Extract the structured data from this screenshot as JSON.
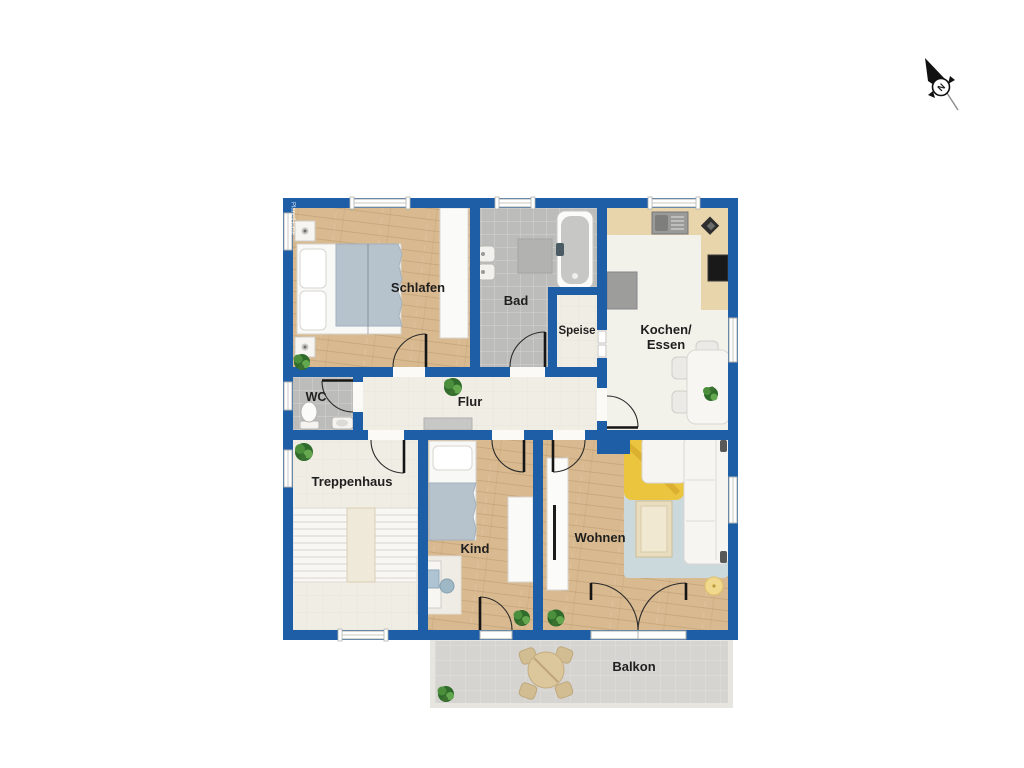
{
  "watermark": {
    "text": "PlanetHome"
  },
  "compass": {
    "north_label": "N"
  },
  "rooms": {
    "schlafen": {
      "label": "Schlafen"
    },
    "bad": {
      "label": "Bad"
    },
    "speise": {
      "label": "Speise"
    },
    "kochen_essen": {
      "label_line1": "Kochen/",
      "label_line2": "Essen"
    },
    "wc": {
      "label": "WC"
    },
    "flur": {
      "label": "Flur"
    },
    "treppenhaus": {
      "label": "Treppenhaus"
    },
    "kind": {
      "label": "Kind"
    },
    "wohnen": {
      "label": "Wohnen"
    },
    "balkon": {
      "label": "Balkon"
    }
  },
  "colors": {
    "wall_blue": "#1e5ea7",
    "wood_floor": "#d9ba90",
    "tile_floor": "#bcbcba",
    "cream_floor": "#f0ede4",
    "kitchen_floor": "#f2f1ea",
    "kitchen_counter": "#e8d5ac",
    "balcony_floor": "#d5d4d0",
    "rug_blue": "#ccd9dc",
    "rug_yellow": "#ecc53f",
    "blanket_blue": "#b6c3cd",
    "plant_green": "#4b8f3d",
    "label_text": "#1f1f1f"
  }
}
